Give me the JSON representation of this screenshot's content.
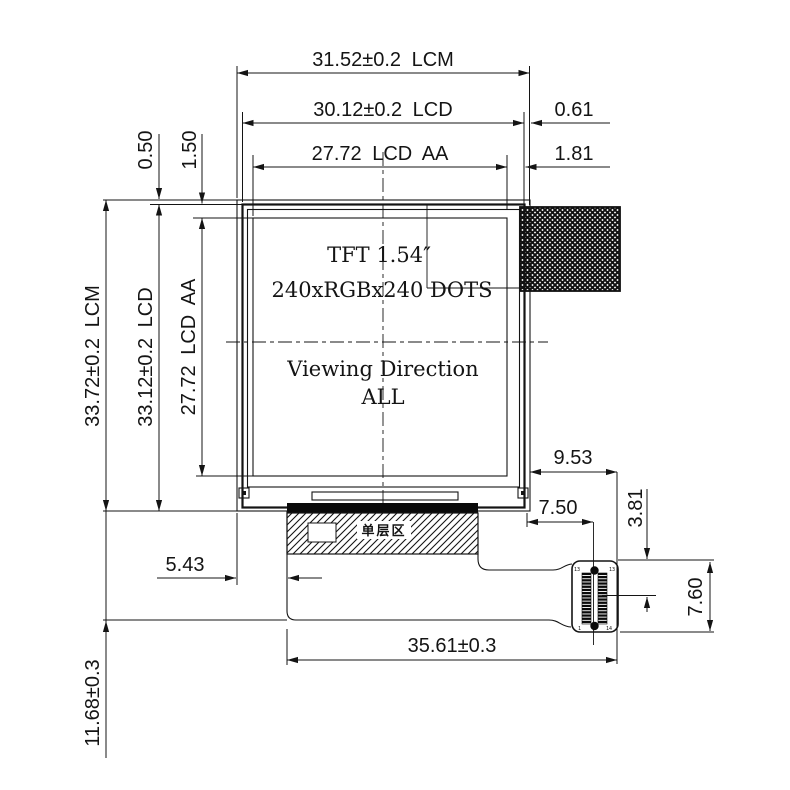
{
  "panel": {
    "size_label": "TFT 1.54″",
    "resolution_label": "240xRGBx240 DOTS",
    "viewing_line1": "Viewing Direction",
    "viewing_line2": "ALL"
  },
  "fpc": {
    "single_layer_label": "单层区"
  },
  "connector": {
    "pin_top_left": "13",
    "pin_top_right": "13",
    "pin_bottom_left": "1",
    "pin_bottom_right": "14"
  },
  "dimensions": {
    "lcm_width": "31.52±0.2 LCM",
    "lcd_width": "30.12±0.2 LCD",
    "aa_width": "27.72 LCD AA",
    "lcm_lcd_right_gap": "0.61",
    "lcd_aa_right_gap": "1.81",
    "lcm_lcd_top_gap": "0.50",
    "lcd_aa_top_gap": "1.50",
    "lcm_height": "33.72±0.2 LCM",
    "lcd_height": "33.12±0.2 LCD",
    "aa_height": "27.72 LCD AA",
    "fpc_left_offset": "5.43",
    "fpc_bottom_drop": "11.68±0.3",
    "fpc_total_width": "35.61±0.3",
    "connector_right_offset": "9.53",
    "connector_center_offset": "7.50",
    "connector_pin_offset": "3.81",
    "connector_height": "7.60"
  }
}
